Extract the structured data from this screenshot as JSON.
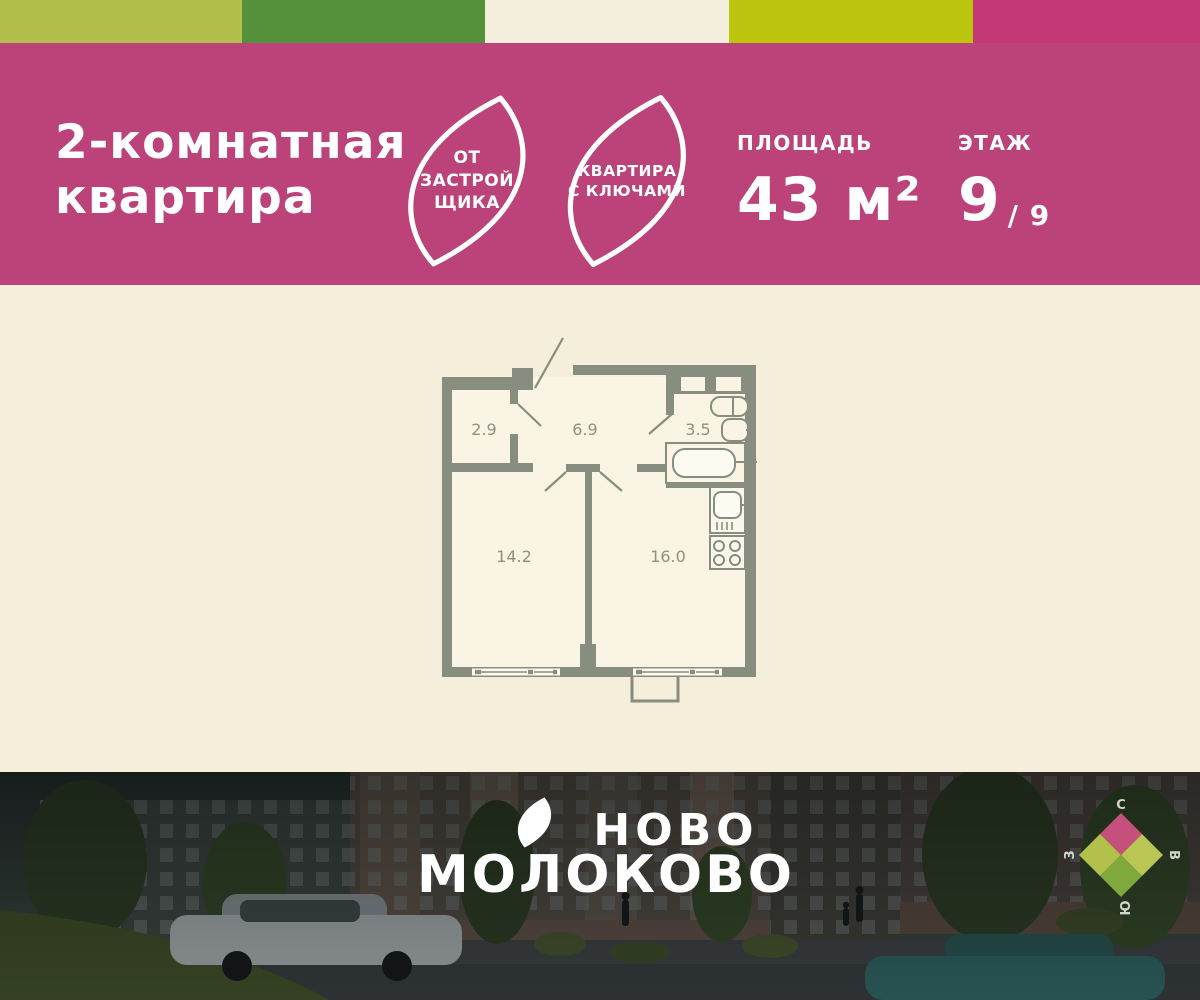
{
  "top_strip": {
    "colors": [
      "#b2bf4a",
      "#55913a",
      "#f4efdc",
      "#bcc40e",
      "#c53878"
    ]
  },
  "header": {
    "bg_color": "#bc4379",
    "title_line1": "2-комнатная",
    "title_line2": "квартира",
    "badges": [
      {
        "name": "from-developer",
        "lines": [
          "ОТ",
          "ЗАСТРОЙ",
          "ЩИКА"
        ]
      },
      {
        "name": "apartment-with-keys",
        "lines": [
          "КВАРТИРА",
          "С КЛЮЧАМИ"
        ]
      }
    ],
    "area": {
      "label": "ПЛОЩАДЬ",
      "value": "43 м²"
    },
    "floor": {
      "label": "ЭТАЖ",
      "value": "9",
      "suffix": "/ 9"
    }
  },
  "floorplan": {
    "background_color": "#f4eedb",
    "wall_color": "#878e80",
    "rooms": [
      {
        "name": "storage",
        "area": "2.9"
      },
      {
        "name": "hallway",
        "area": "6.9"
      },
      {
        "name": "bathroom",
        "area": "3.5"
      },
      {
        "name": "living-room",
        "area": "14.2"
      },
      {
        "name": "kitchen-living",
        "area": "16.0"
      }
    ]
  },
  "footer": {
    "brand_line1": "НОВО",
    "brand_line2": "МОЛОКОВО",
    "compass": {
      "north": "С",
      "east": "В",
      "south": "Ю",
      "west": "З",
      "colors": {
        "north": "#c4507b",
        "east": "#bac654",
        "south": "#7fa83d",
        "west": "#b3c04c"
      }
    }
  }
}
